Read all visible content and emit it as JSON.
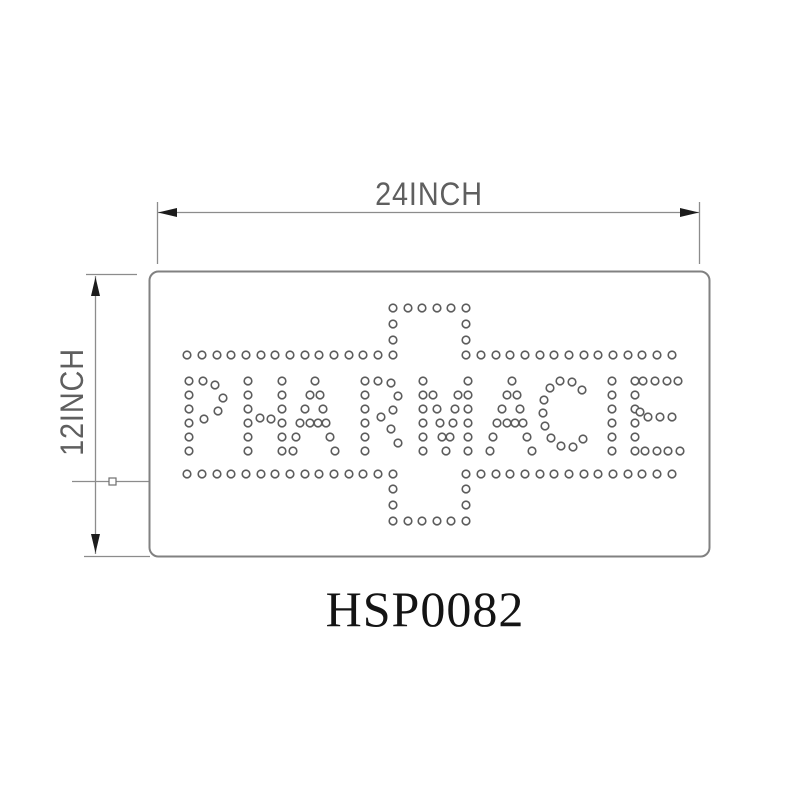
{
  "title": "LED pharmacy sign technical drawing",
  "dimensions": {
    "width_label": "24INCH",
    "height_label": "12INCH"
  },
  "part_number": "HSP0082",
  "colors": {
    "line_gray": "#8c8c8c",
    "outline_gray": "#818181",
    "arrow_black": "#1c1c1c",
    "dim_text_gray": "#5f5f5f",
    "dot_stroke_gray": "#5c5c5c",
    "label_black": "#141414",
    "background": "#ffffff"
  },
  "sign": {
    "text": "PHARMACIE",
    "symbol": "pharmacy-cross",
    "rect": {
      "x": 149.5,
      "y": 271.5,
      "width": 560,
      "height": 285,
      "corner_radius": 9
    },
    "dot": {
      "radius": 3.8,
      "stroke_width": 1.6
    },
    "led_pattern": {
      "origin": [
        149,
        271
      ],
      "cross_rows": [
        {
          "y": 37,
          "xs": [
            244,
            259,
            273,
            288,
            302,
            317
          ]
        },
        {
          "y": 53,
          "xs": [
            244,
            317
          ]
        },
        {
          "y": 69,
          "xs": [
            244,
            317
          ]
        },
        {
          "y": 84,
          "xs": [
            38,
            53,
            68,
            82,
            97,
            112,
            126,
            141,
            156,
            170,
            185,
            200,
            214,
            229,
            244,
            317,
            332,
            347,
            361,
            376,
            391,
            405,
            420,
            435,
            449,
            464,
            479,
            493,
            508,
            523
          ]
        },
        {
          "y": 203,
          "xs": [
            38,
            53,
            68,
            82,
            97,
            112,
            126,
            141,
            156,
            170,
            185,
            200,
            214,
            229,
            244,
            317,
            332,
            347,
            361,
            376,
            391,
            405,
            420,
            435,
            449,
            464,
            479,
            493,
            508,
            523
          ]
        },
        {
          "y": 218,
          "xs": [
            244,
            317
          ]
        },
        {
          "y": 234,
          "xs": [
            244,
            317
          ]
        },
        {
          "y": 250,
          "xs": [
            244,
            259,
            273,
            288,
            302,
            317
          ]
        }
      ],
      "letters": [
        {
          "char": "P",
          "x": 40,
          "y": 110,
          "dots": [
            [
              0,
              0
            ],
            [
              0,
              14
            ],
            [
              0,
              28
            ],
            [
              0,
              42
            ],
            [
              0,
              56
            ],
            [
              0,
              70
            ],
            [
              14,
              0
            ],
            [
              26,
              4
            ],
            [
              34,
              17
            ],
            [
              29,
              30
            ],
            [
              15,
              38
            ]
          ]
        },
        {
          "char": "H",
          "x": 99,
          "y": 110,
          "dots": [
            [
              0,
              0
            ],
            [
              0,
              14
            ],
            [
              0,
              28
            ],
            [
              0,
              42
            ],
            [
              0,
              56
            ],
            [
              0,
              70
            ],
            [
              34,
              0
            ],
            [
              34,
              14
            ],
            [
              34,
              28
            ],
            [
              34,
              42
            ],
            [
              34,
              56
            ],
            [
              34,
              70
            ],
            [
              12,
              37
            ],
            [
              23,
              38
            ]
          ]
        },
        {
          "char": "A",
          "x": 144,
          "y": 110,
          "dots": [
            [
              22,
              0
            ],
            [
              17,
              14
            ],
            [
              27,
              14
            ],
            [
              12,
              28
            ],
            [
              30,
              28
            ],
            [
              7,
              42
            ],
            [
              17,
              42
            ],
            [
              25,
              42
            ],
            [
              33,
              42
            ],
            [
              3,
              56
            ],
            [
              37,
              56
            ],
            [
              0,
              70
            ],
            [
              42,
              70
            ]
          ]
        },
        {
          "char": "R",
          "x": 216,
          "y": 110,
          "dots": [
            [
              0,
              0
            ],
            [
              0,
              14
            ],
            [
              0,
              28
            ],
            [
              0,
              42
            ],
            [
              0,
              56
            ],
            [
              0,
              70
            ],
            [
              13,
              0
            ],
            [
              26,
              2
            ],
            [
              33,
              15
            ],
            [
              28,
              29
            ],
            [
              16,
              36
            ],
            [
              26,
              48
            ],
            [
              33,
              62
            ]
          ]
        },
        {
          "char": "M",
          "x": 274,
          "y": 110,
          "dots": [
            [
              0,
              0
            ],
            [
              0,
              14
            ],
            [
              0,
              28
            ],
            [
              0,
              42
            ],
            [
              0,
              56
            ],
            [
              0,
              70
            ],
            [
              45,
              0
            ],
            [
              45,
              14
            ],
            [
              45,
              28
            ],
            [
              45,
              42
            ],
            [
              45,
              56
            ],
            [
              45,
              70
            ],
            [
              10,
              14
            ],
            [
              35,
              14
            ],
            [
              14,
              28
            ],
            [
              32,
              28
            ],
            [
              17,
              42
            ],
            [
              30,
              42
            ],
            [
              19,
              56
            ],
            [
              27,
              56
            ],
            [
              23,
              70
            ]
          ]
        },
        {
          "char": "A",
          "x": 341,
          "y": 110,
          "dots": [
            [
              22,
              0
            ],
            [
              17,
              14
            ],
            [
              27,
              14
            ],
            [
              12,
              28
            ],
            [
              30,
              28
            ],
            [
              7,
              42
            ],
            [
              17,
              42
            ],
            [
              25,
              42
            ],
            [
              33,
              42
            ],
            [
              3,
              56
            ],
            [
              37,
              56
            ],
            [
              0,
              70
            ],
            [
              42,
              70
            ]
          ]
        },
        {
          "char": "C",
          "x": 394,
          "y": 110,
          "dots": [
            [
              17,
              0
            ],
            [
              29,
              1
            ],
            [
              39,
              9
            ],
            [
              7,
              7
            ],
            [
              1,
              19
            ],
            [
              0,
              32
            ],
            [
              2,
              45
            ],
            [
              8,
              57
            ],
            [
              18,
              65
            ],
            [
              30,
              66
            ],
            [
              40,
              58
            ]
          ]
        },
        {
          "char": "I",
          "x": 463,
          "y": 110,
          "dots": [
            [
              0,
              0
            ],
            [
              0,
              14
            ],
            [
              0,
              28
            ],
            [
              0,
              42
            ],
            [
              0,
              56
            ],
            [
              0,
              70
            ]
          ]
        },
        {
          "char": "E",
          "x": 486,
          "y": 110,
          "dots": [
            [
              0,
              0
            ],
            [
              0,
              14
            ],
            [
              0,
              28
            ],
            [
              0,
              42
            ],
            [
              0,
              56
            ],
            [
              0,
              70
            ],
            [
              8,
              0
            ],
            [
              20,
              0
            ],
            [
              32,
              0
            ],
            [
              43,
              0
            ],
            [
              5,
              31
            ],
            [
              13,
              36
            ],
            [
              25,
              36
            ],
            [
              37,
              36
            ],
            [
              10,
              70
            ],
            [
              22,
              70
            ],
            [
              33,
              70
            ],
            [
              45,
              70
            ]
          ]
        }
      ]
    }
  }
}
